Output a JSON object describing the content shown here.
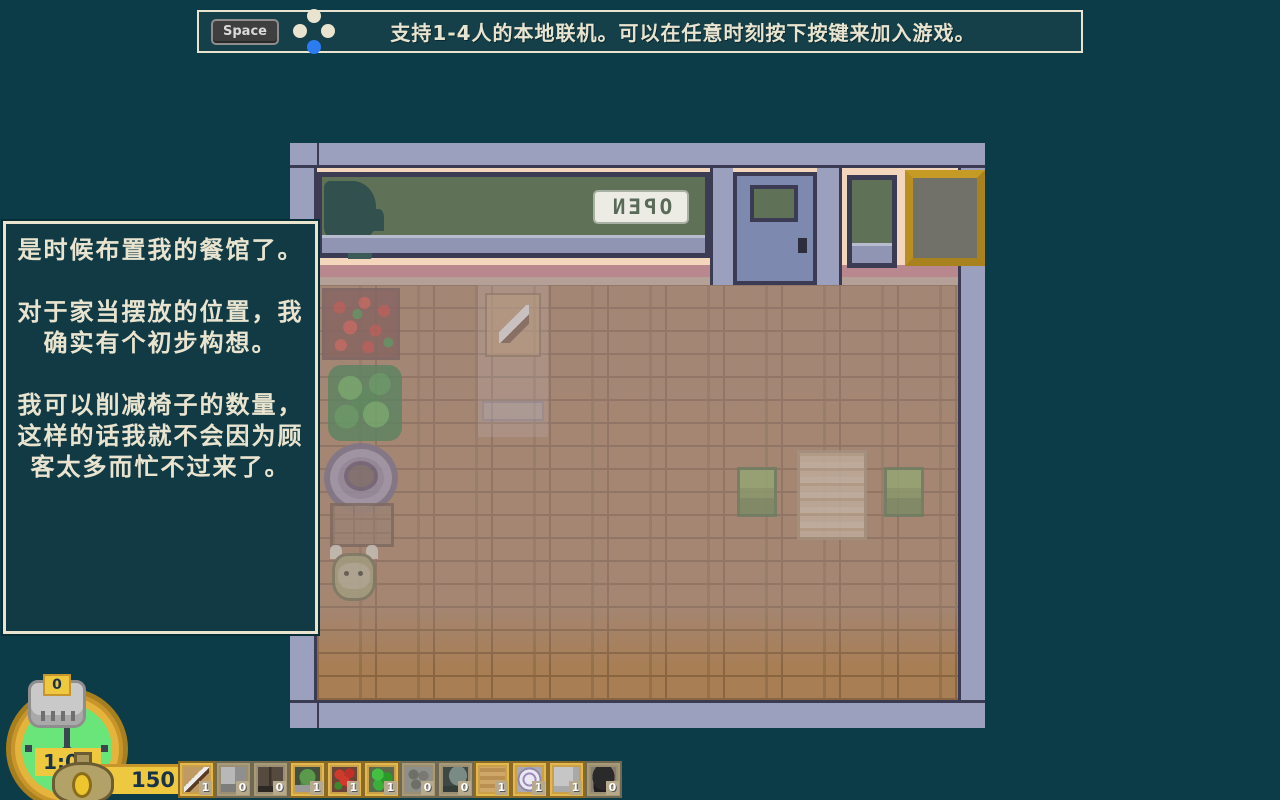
{
  "colors": {
    "background": "#0d3c49",
    "panel": "#113a45",
    "cream": "#e9e4cf",
    "gold": "#eec83f",
    "pad_button_blue": "#2a7cf0",
    "wall_gray": "#9aa0bd",
    "storefront_peach": "#f4d6bc",
    "floor_wood": "#a87e55"
  },
  "top_banner": {
    "key_label": "Space",
    "message": "支持1-4人的本地联机。可以在任意时刻按下按键来加入游戏。"
  },
  "dialog": {
    "paragraphs": [
      "是时候布置我的餐馆了。",
      "对于家当摆放的位置，我确实有个初步构想。",
      "我可以削减椅子的数量，这样的话我就不会因为顾客太多而忙不过来了。"
    ]
  },
  "scene": {
    "open_sign_text": "OPEN",
    "open_sign_mirrored": true
  },
  "hud": {
    "bell_count": "0",
    "clock_time": "1:00",
    "money": "150"
  },
  "hotbar": {
    "slots": [
      {
        "item": "cutting-board",
        "count": "1"
      },
      {
        "item": "gray-counter",
        "count": "0"
      },
      {
        "item": "dark-door",
        "count": "0"
      },
      {
        "item": "potted-plant",
        "count": "1"
      },
      {
        "item": "red-flowers",
        "count": "1"
      },
      {
        "item": "green-bush",
        "count": "1"
      },
      {
        "item": "stone-path",
        "count": "0"
      },
      {
        "item": "stove",
        "count": "0"
      },
      {
        "item": "hay-mat",
        "count": "1"
      },
      {
        "item": "plate",
        "count": "1"
      },
      {
        "item": "white-panel",
        "count": "1"
      },
      {
        "item": "cauldron",
        "count": "0"
      }
    ]
  }
}
